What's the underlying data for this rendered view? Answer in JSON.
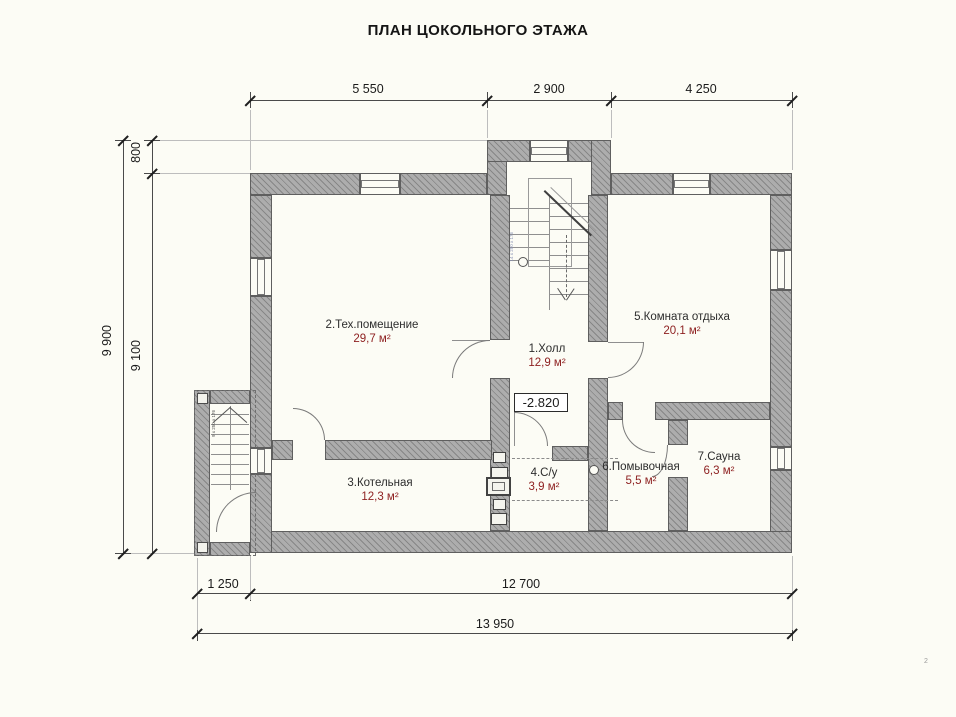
{
  "title": "ПЛАН ЦОКОЛЬНОГО ЭТАЖА",
  "dimensions": {
    "top": [
      "5 550",
      "2 900",
      "4 250"
    ],
    "left_outer": "9 900",
    "left_inner_top": "800",
    "left_inner": "9 100",
    "bottom_porch": "1 250",
    "bottom_main": "12 700",
    "bottom_total": "13 950"
  },
  "elevation": "-2.820",
  "rooms": [
    {
      "name": "1.Холл",
      "area": "12,9 м²"
    },
    {
      "name": "2.Тех.помещение",
      "area": "29,7 м²"
    },
    {
      "name": "3.Котельная",
      "area": "12,3 м²"
    },
    {
      "name": "4.С/у",
      "area": "3,9 м²"
    },
    {
      "name": "5.Комната отдыха",
      "area": "20,1 м²"
    },
    {
      "name": "6.Помывочная",
      "area": "5,5 м²"
    },
    {
      "name": "7.Сауна",
      "area": "6,3 м²"
    }
  ],
  "stairs": {
    "porch_note": "9 x 250 x 176",
    "main_note": "14 x 250 x 176"
  },
  "page_number": "2",
  "colors": {
    "background": "#fcfcf5",
    "wall_fill": "#adadad",
    "area_text": "#8d1f1f",
    "line": "#4a4a4a"
  }
}
